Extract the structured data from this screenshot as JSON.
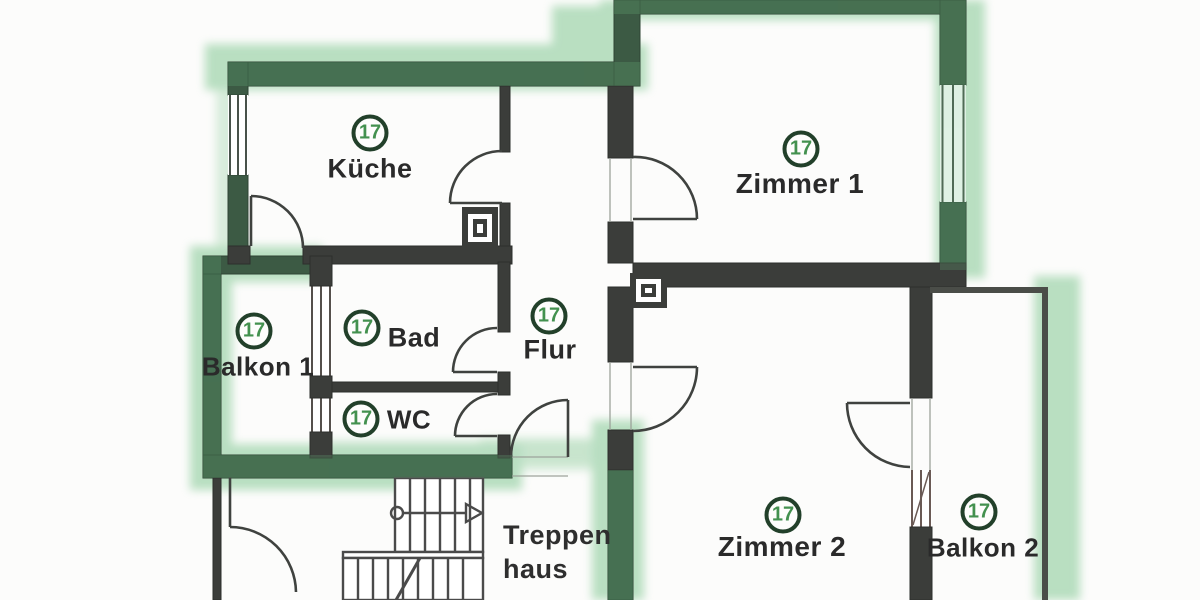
{
  "unit_badge": {
    "number": "17"
  },
  "rooms": [
    {
      "id": "kueche",
      "name": "Küche",
      "badge": "17"
    },
    {
      "id": "zimmer1",
      "name": "Zimmer 1",
      "badge": "17"
    },
    {
      "id": "balkon1",
      "name": "Balkon 1",
      "badge": "17"
    },
    {
      "id": "bad",
      "name": "Bad",
      "badge": "17"
    },
    {
      "id": "flur",
      "name": "Flur",
      "badge": "17"
    },
    {
      "id": "wc",
      "name": "WC",
      "badge": "17"
    },
    {
      "id": "zimmer2",
      "name": "Zimmer 2",
      "badge": "17"
    },
    {
      "id": "balkon2",
      "name": "Balkon 2",
      "badge": "17"
    }
  ],
  "stairwell": {
    "line1": "Treppen",
    "line2": "haus"
  },
  "colors": {
    "highlight_green": "#76c287",
    "wall_exterior": "#3c5a44",
    "wall_interior": "#3b3d3a",
    "badge_ring": "#22402a",
    "badge_number": "#43914f",
    "label_text": "#2a2a2a",
    "paper": "#fcfcfb"
  }
}
